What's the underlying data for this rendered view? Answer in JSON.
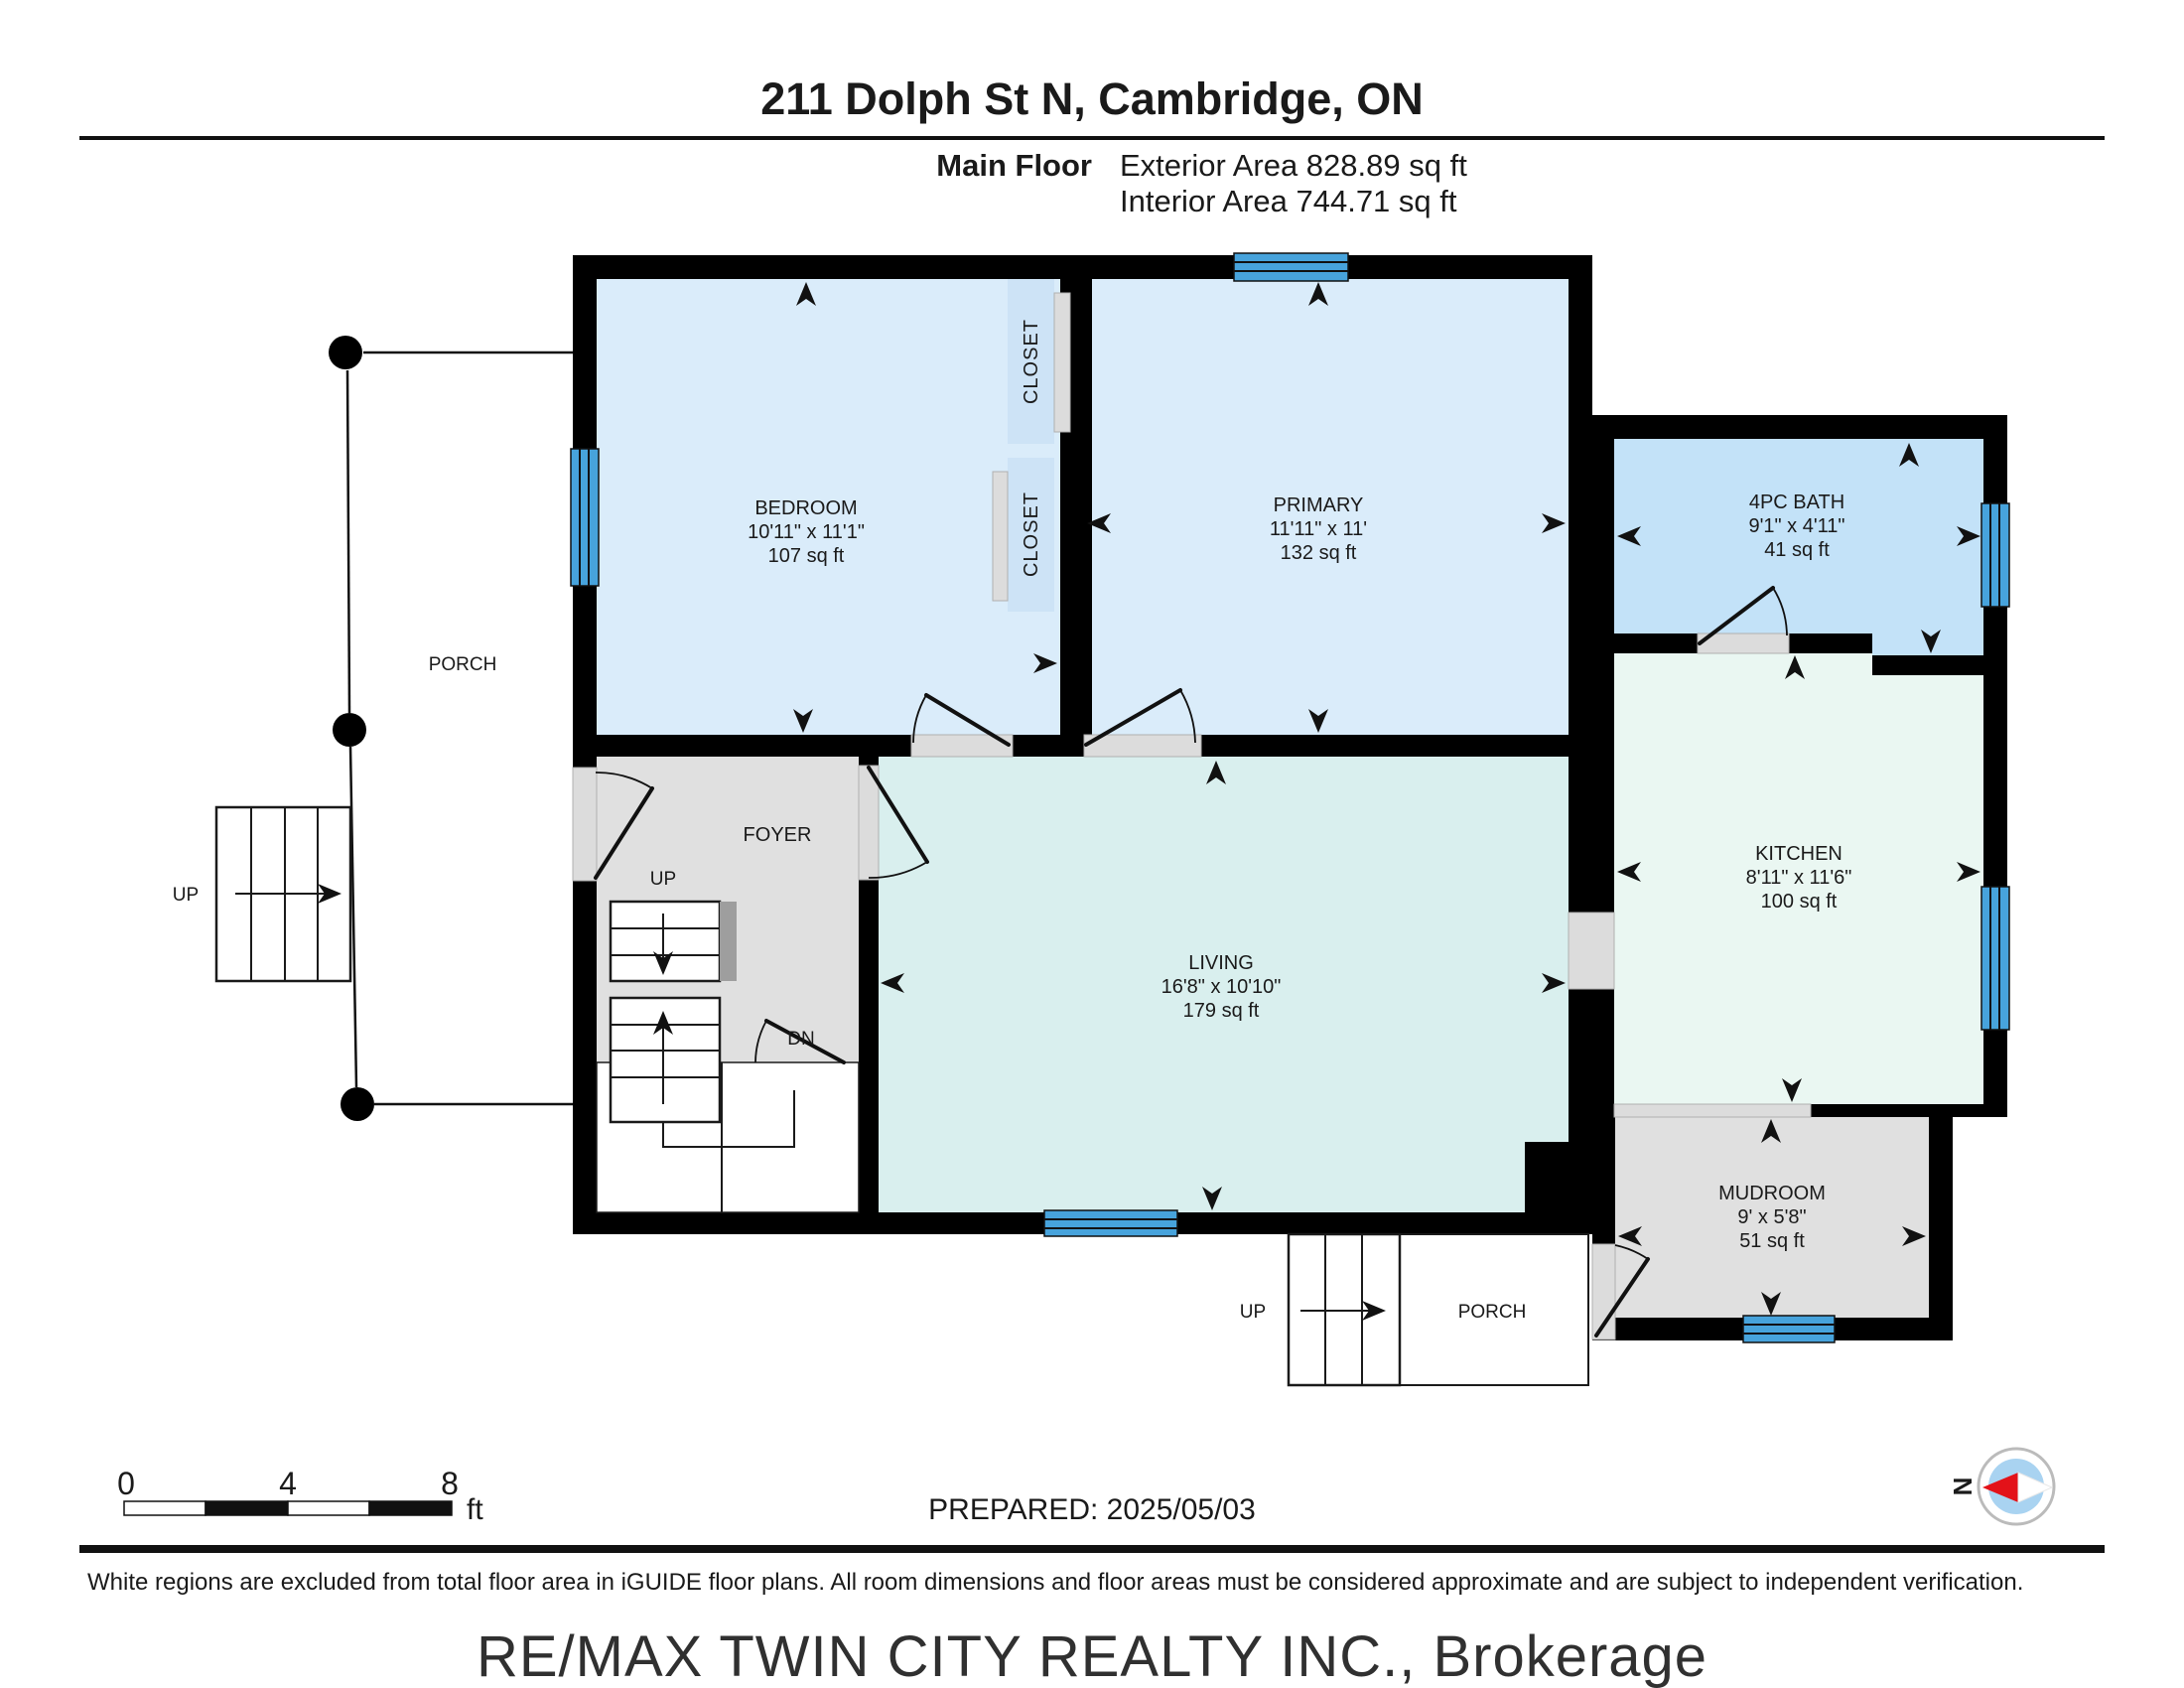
{
  "header": {
    "title": "211 Dolph St N, Cambridge, ON",
    "floor_label": "Main Floor",
    "exterior_area": "Exterior Area 828.89 sq ft",
    "interior_area": "Interior Area 744.71 sq ft"
  },
  "rooms": {
    "bedroom": {
      "name": "BEDROOM",
      "dims": "10'11\" x 11'1\"",
      "area": "107 sq ft"
    },
    "primary": {
      "name": "PRIMARY",
      "dims": "11'11\" x 11'",
      "area": "132 sq ft"
    },
    "bath": {
      "name": "4PC BATH",
      "dims": "9'1\" x 4'11\"",
      "area": "41 sq ft"
    },
    "kitchen": {
      "name": "KITCHEN",
      "dims": "8'11\" x 11'6\"",
      "area": "100 sq ft"
    },
    "living": {
      "name": "LIVING",
      "dims": "16'8\" x 10'10\"",
      "area": "179 sq ft"
    },
    "mudroom": {
      "name": "MUDROOM",
      "dims": "9' x 5'8\"",
      "area": "51 sq ft"
    },
    "foyer": {
      "name": "FOYER"
    },
    "closet_top": {
      "name": "CLOSET"
    },
    "closet_bottom": {
      "name": "CLOSET"
    },
    "porch_left": {
      "name": "PORCH"
    },
    "porch_bottom": {
      "name": "PORCH"
    }
  },
  "stairs": {
    "left_up": "UP",
    "foyer_up": "UP",
    "foyer_dn": "DN",
    "porch_up": "UP"
  },
  "scale_bar": {
    "tick0": "0",
    "tick4": "4",
    "tick8": "8",
    "unit": "ft"
  },
  "compass": {
    "north": "N"
  },
  "footer": {
    "prepared": "PREPARED: 2025/05/03",
    "disclaimer": "White regions are excluded from total floor area in iGUIDE floor plans. All room dimensions and floor areas must be considered approximate and are subject to independent verification.",
    "watermark": "RE/MAX TWIN CITY REALTY INC., Brokerage"
  },
  "colors": {
    "wall": "#000000",
    "window_blue": "#47a3dc",
    "room_blue": "#daecfa",
    "closet_blue": "#cde3f6",
    "bath_blue": "#c3e2f8",
    "living_teal": "#d9efee",
    "kitchen_mint": "#eaf7f2",
    "gray_floor": "#e0e0e0",
    "door_gray": "#dcdcdc",
    "handrail_gray": "#9e9e9e",
    "compass_red": "#e31219",
    "compass_inner": "#a9d3f1",
    "compass_ring": "#bbbbbb",
    "watermark_gray": "#c9c9c9"
  }
}
